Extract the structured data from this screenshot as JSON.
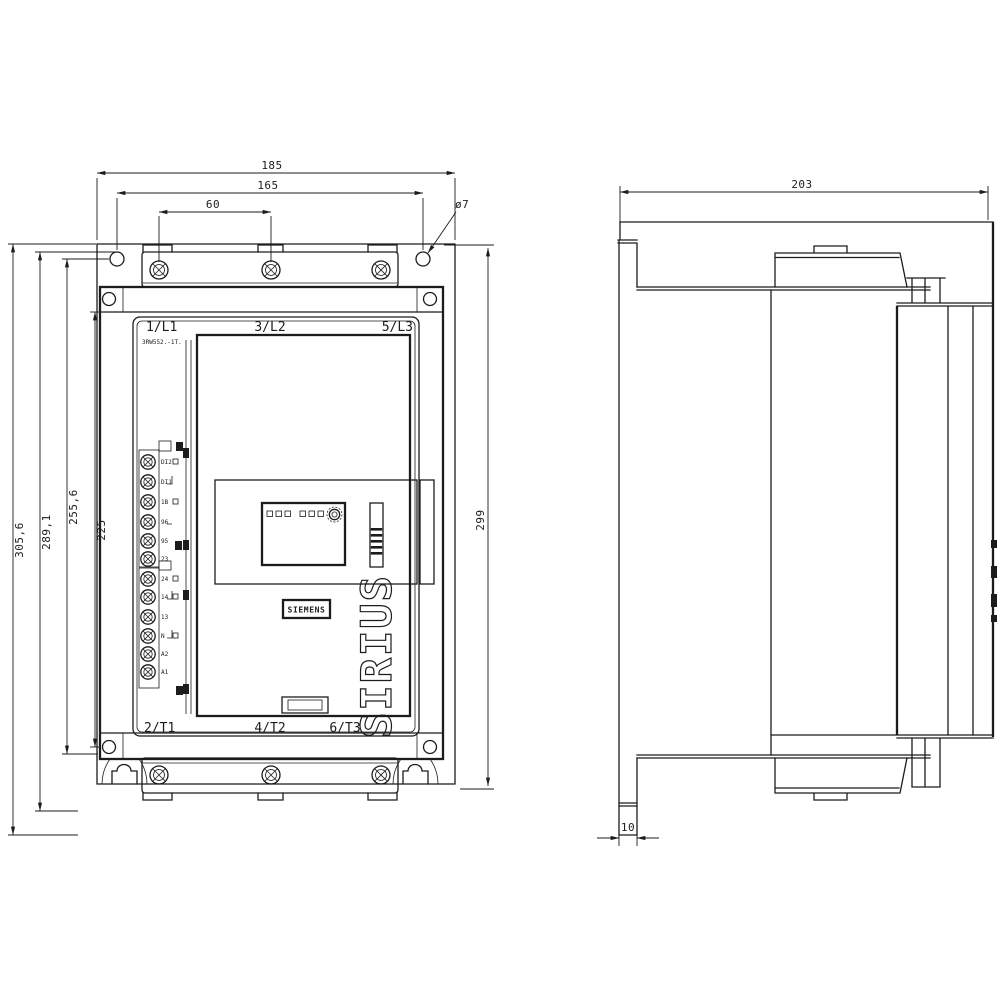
{
  "product": {
    "brand": "SIEMENS",
    "series": "SIRIUS",
    "model": "3RW552.-1T."
  },
  "front_view": {
    "top_terminal_labels": {
      "t1": "1/L1",
      "t2": "3/L2",
      "t3": "5/L3"
    },
    "bottom_terminal_labels": {
      "b1": "2/T1",
      "b2": "4/T2",
      "b3": "6/T3"
    },
    "control_terminals": [
      "DI2",
      "DI1",
      "1B",
      "96",
      "95",
      "23",
      "24",
      "14",
      "13",
      "N",
      "A2",
      "A1"
    ]
  },
  "dimensions": {
    "overall_width": "185",
    "hole_spacing": "165",
    "busbar_pitch": "60",
    "hole_dia": "ø7",
    "h_total": "305,6",
    "h_289": "289,1",
    "h_255": "255,6",
    "h_225": "225",
    "h_right": "299",
    "depth": "203",
    "standoff": "10"
  }
}
